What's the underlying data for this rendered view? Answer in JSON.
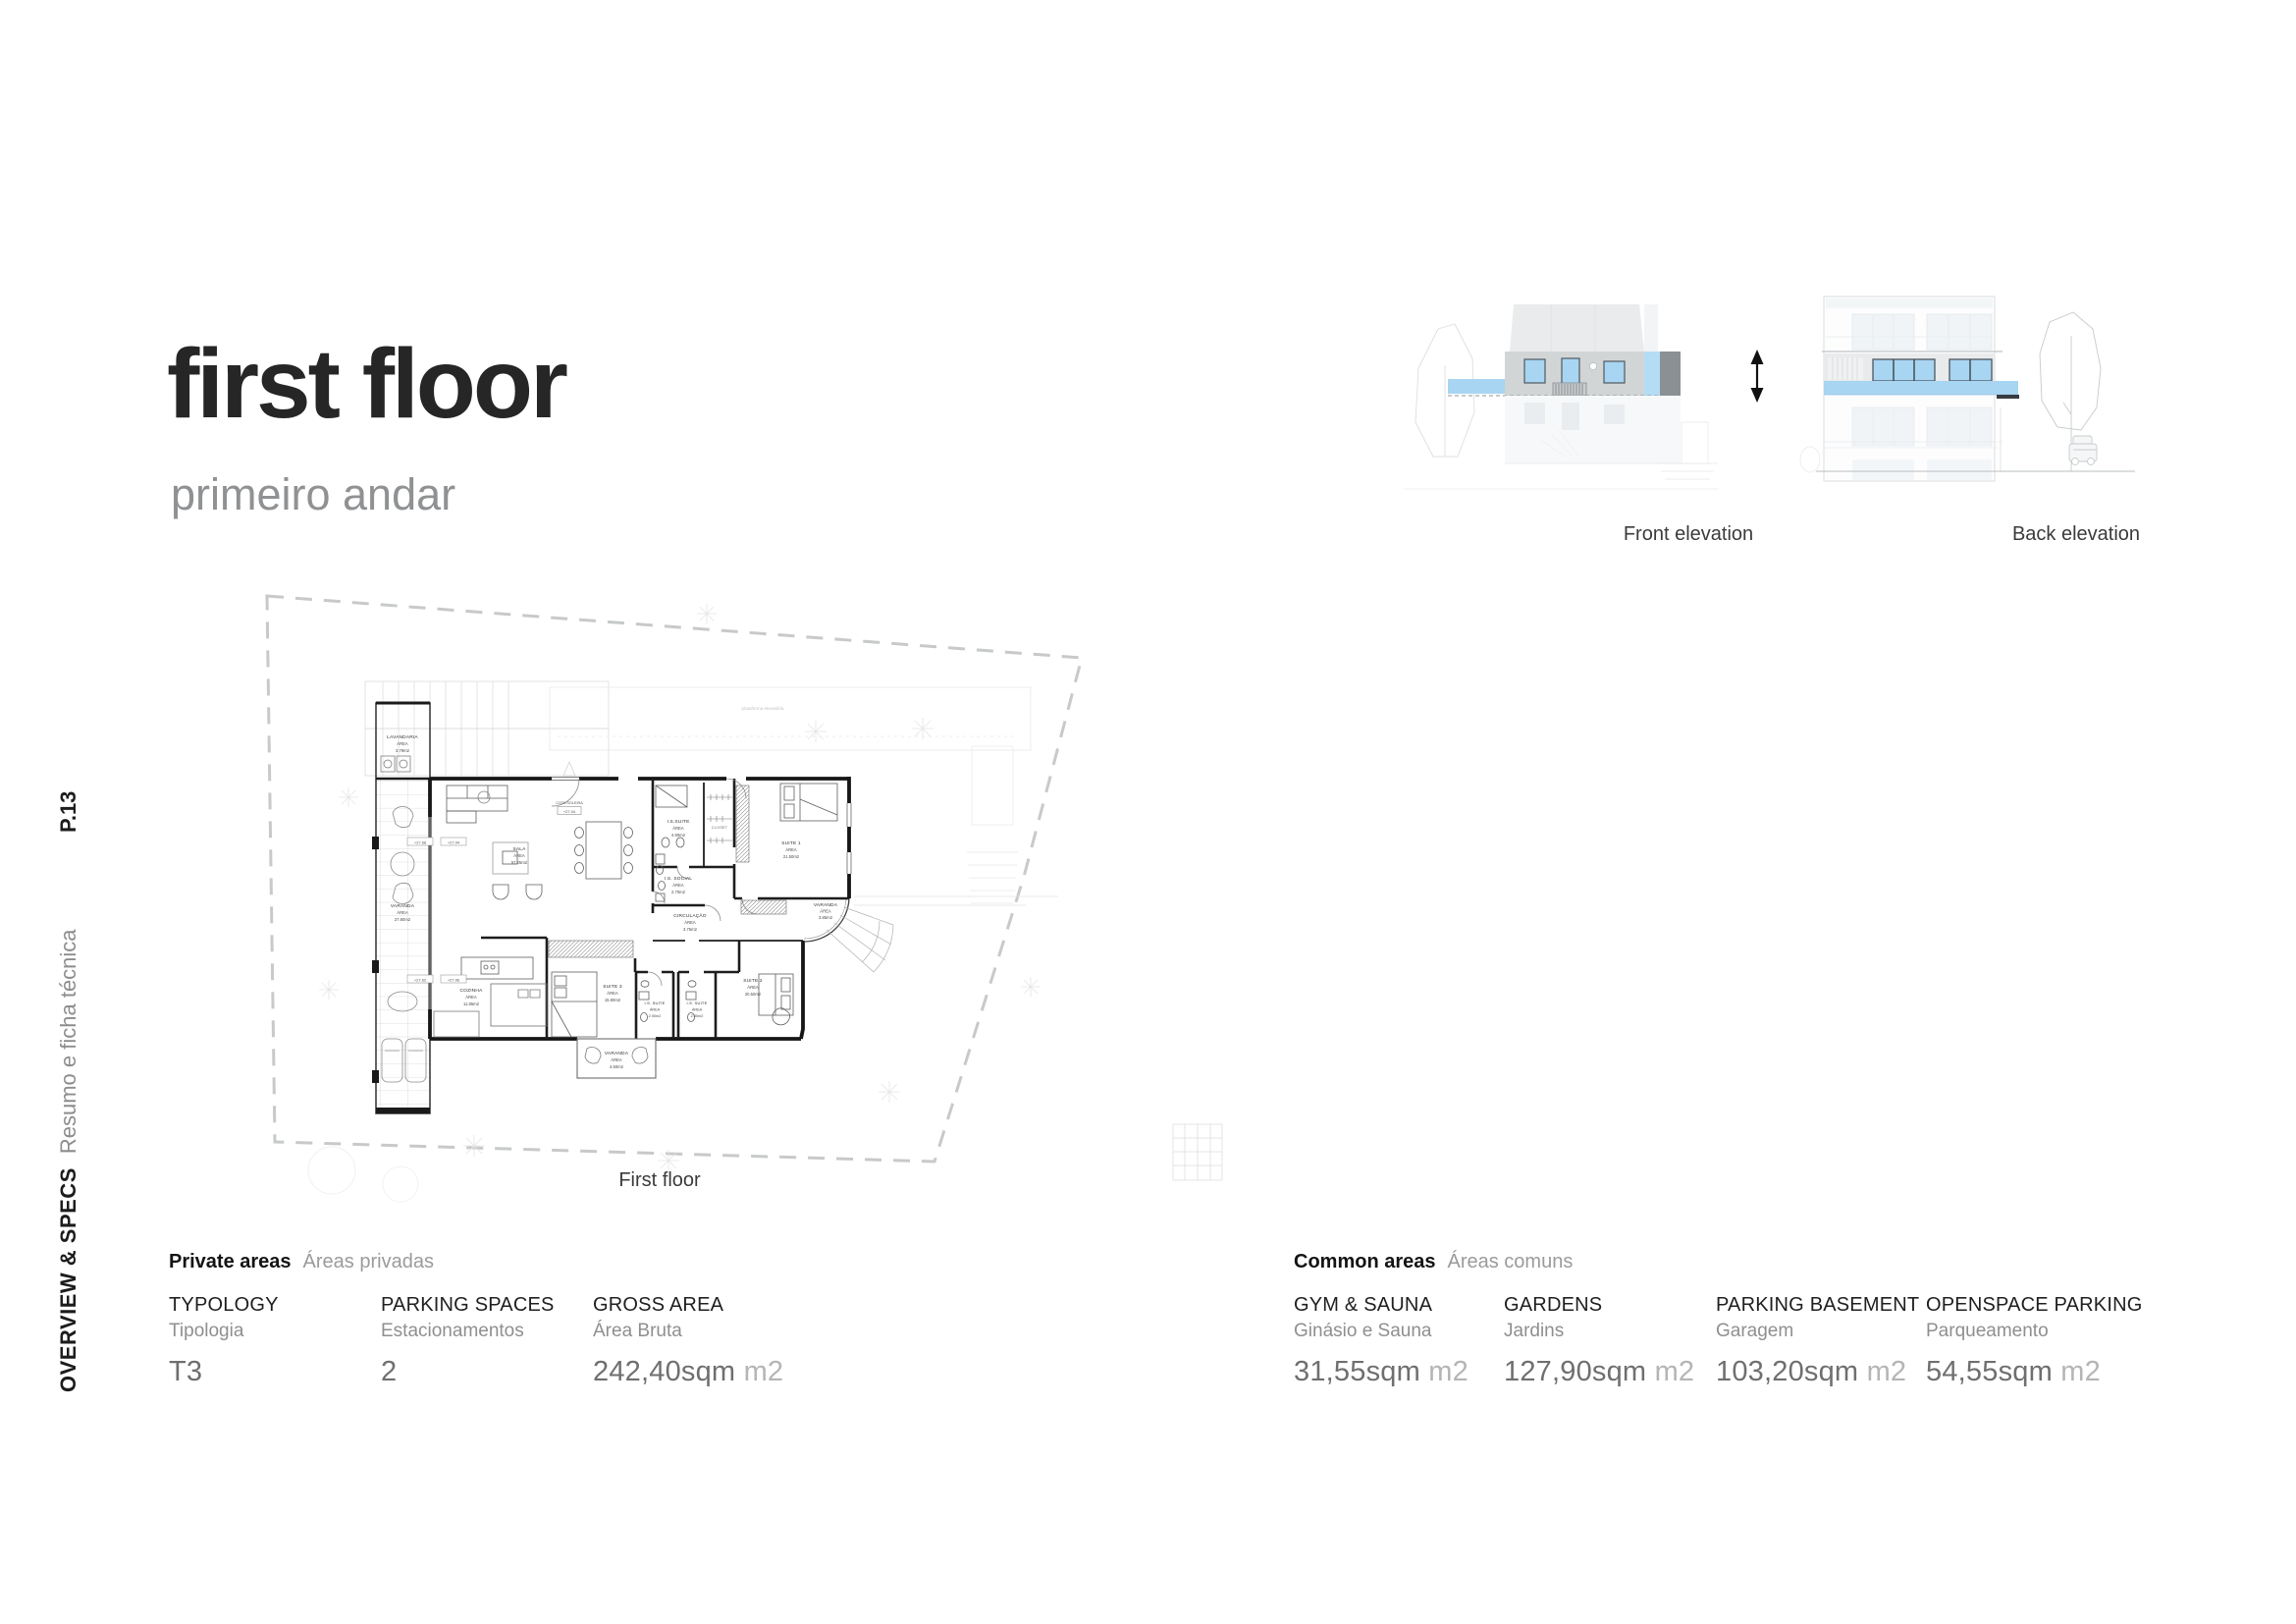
{
  "page": {
    "number": "P.13",
    "section_en": "OVERVIEW & SPECS",
    "section_pt": "Resumo e ficha técnica"
  },
  "title": {
    "main": "first floor",
    "sub": "primeiro andar"
  },
  "plan": {
    "caption": "First floor",
    "area_label": "ÁREA",
    "site_note": "plataforma elevatória",
    "entry_note": "COTA SOLEIRA",
    "entry_level": "+27.04",
    "levels": [
      "+27.68",
      "+27.04",
      "+27.62",
      "+27.06"
    ],
    "closet_label": "CLOSET",
    "rooms": [
      {
        "name": "LAVANDARIA",
        "area": "3.79m2"
      },
      {
        "name": "VARANDA",
        "area": "27.80m2"
      },
      {
        "name": "SALA",
        "area": "57.25m2"
      },
      {
        "name": "I.S.SUITE",
        "area": "4.90m2"
      },
      {
        "name": "SUITE 1",
        "area": "21.50m2"
      },
      {
        "name": "I.S. SOCIAL",
        "area": "2.70m2"
      },
      {
        "name": "CIRCULAÇÃO",
        "area": "3.75m2"
      },
      {
        "name": "VARANDA",
        "area": "3.85m2"
      },
      {
        "name": "COZINHA",
        "area": "11.85m2"
      },
      {
        "name": "SUITE 3",
        "area": "15.80m2"
      },
      {
        "name": "I.S. SUITE",
        "area": "2.90m2"
      },
      {
        "name": "I.S. SUITE",
        "area": "2.80m2"
      },
      {
        "name": "SUITE 2",
        "area": "20.50m2"
      },
      {
        "name": "VARANDA",
        "area": "4.50m2"
      }
    ]
  },
  "elevations": {
    "front_label": "Front elevation",
    "back_label": "Back elevation"
  },
  "colors": {
    "highlight_blue": "#a8d5f1",
    "highlight_gray": "#d2d5d6",
    "dark_block": "#8b9094"
  },
  "specs": {
    "private": {
      "heading_en": "Private areas",
      "heading_pt": "Áreas privadas",
      "items": [
        {
          "label_en": "TYPOLOGY",
          "label_pt": "Tipologia",
          "value": "T3",
          "unit": ""
        },
        {
          "label_en": "PARKING SPACES",
          "label_pt": "Estacionamentos",
          "value": "2",
          "unit": ""
        },
        {
          "label_en": "GROSS AREA",
          "label_pt": "Área Bruta",
          "value": "242,40sqm",
          "unit": "m2"
        }
      ]
    },
    "common": {
      "heading_en": "Common areas",
      "heading_pt": "Áreas comuns",
      "items": [
        {
          "label_en": "GYM & SAUNA",
          "label_pt": "Ginásio e Sauna",
          "value": "31,55sqm",
          "unit": "m2"
        },
        {
          "label_en": "GARDENS",
          "label_pt": "Jardins",
          "value": "127,90sqm",
          "unit": "m2"
        },
        {
          "label_en": "PARKING BASEMENT",
          "label_pt": "Garagem",
          "value": "103,20sqm",
          "unit": "m2"
        },
        {
          "label_en": "OPENSPACE PARKING",
          "label_pt": "Parqueamento",
          "value": "54,55sqm",
          "unit": "m2"
        }
      ]
    }
  }
}
